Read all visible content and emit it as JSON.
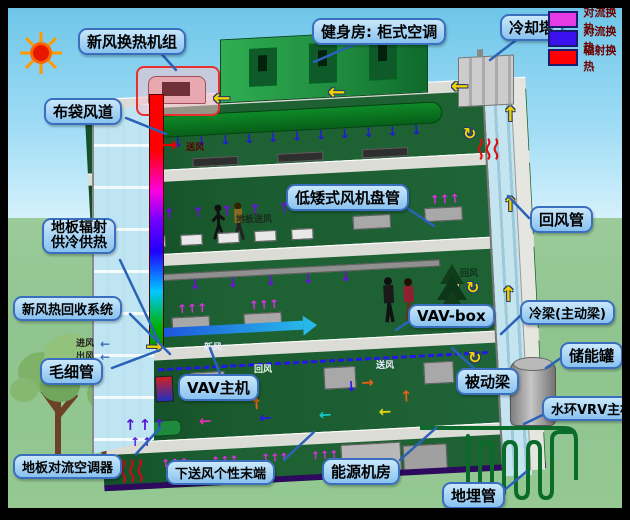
{
  "diagram_title": "建筑暖通空调系统剖面示意图",
  "legend": {
    "items": [
      {
        "label": "对流换热",
        "color": "#E43BE4"
      },
      {
        "label": "对流换热",
        "color": "#3A10EE"
      },
      {
        "label": "辐射换热",
        "color": "#FF0000"
      }
    ]
  },
  "labels": {
    "fresh_air_unit": "新风换热机组",
    "gym_ac": "健身房: 柜式空调",
    "cooling_tower": "冷却塔",
    "bag_duct": "布袋风道",
    "floor_radiant_line1": "地板辐射",
    "floor_radiant_line2": "供冷供热",
    "heat_recovery": "新风热回收系统",
    "capillary": "毛细管",
    "floor_convection": "地板对流空调器",
    "low_fan_coil": "低矮式风机盘管",
    "vav_box": "VAV-box",
    "vav_host": "VAV主机",
    "underfloor_terminal": "下送风个性末端",
    "energy_room": "能源机房",
    "ground_pipe": "地埋管",
    "return_duct": "回风管",
    "cold_beam": "冷梁(主动梁)",
    "passive_beam": "被动梁",
    "storage_tank": "储能罐",
    "vrv_host": "水环VRV主机"
  },
  "small_texts": {
    "supply_air_top": "送风",
    "floor_supply": "地板送风",
    "fresh_air": "新风",
    "return_air_mid": "回风",
    "return_air_low": "回风",
    "supply_air_low": "送风",
    "air_in": "进风",
    "air_out": "出风"
  },
  "icons": {
    "sun": "sun-icon",
    "legend_swatch": "color-swatch-icon"
  }
}
